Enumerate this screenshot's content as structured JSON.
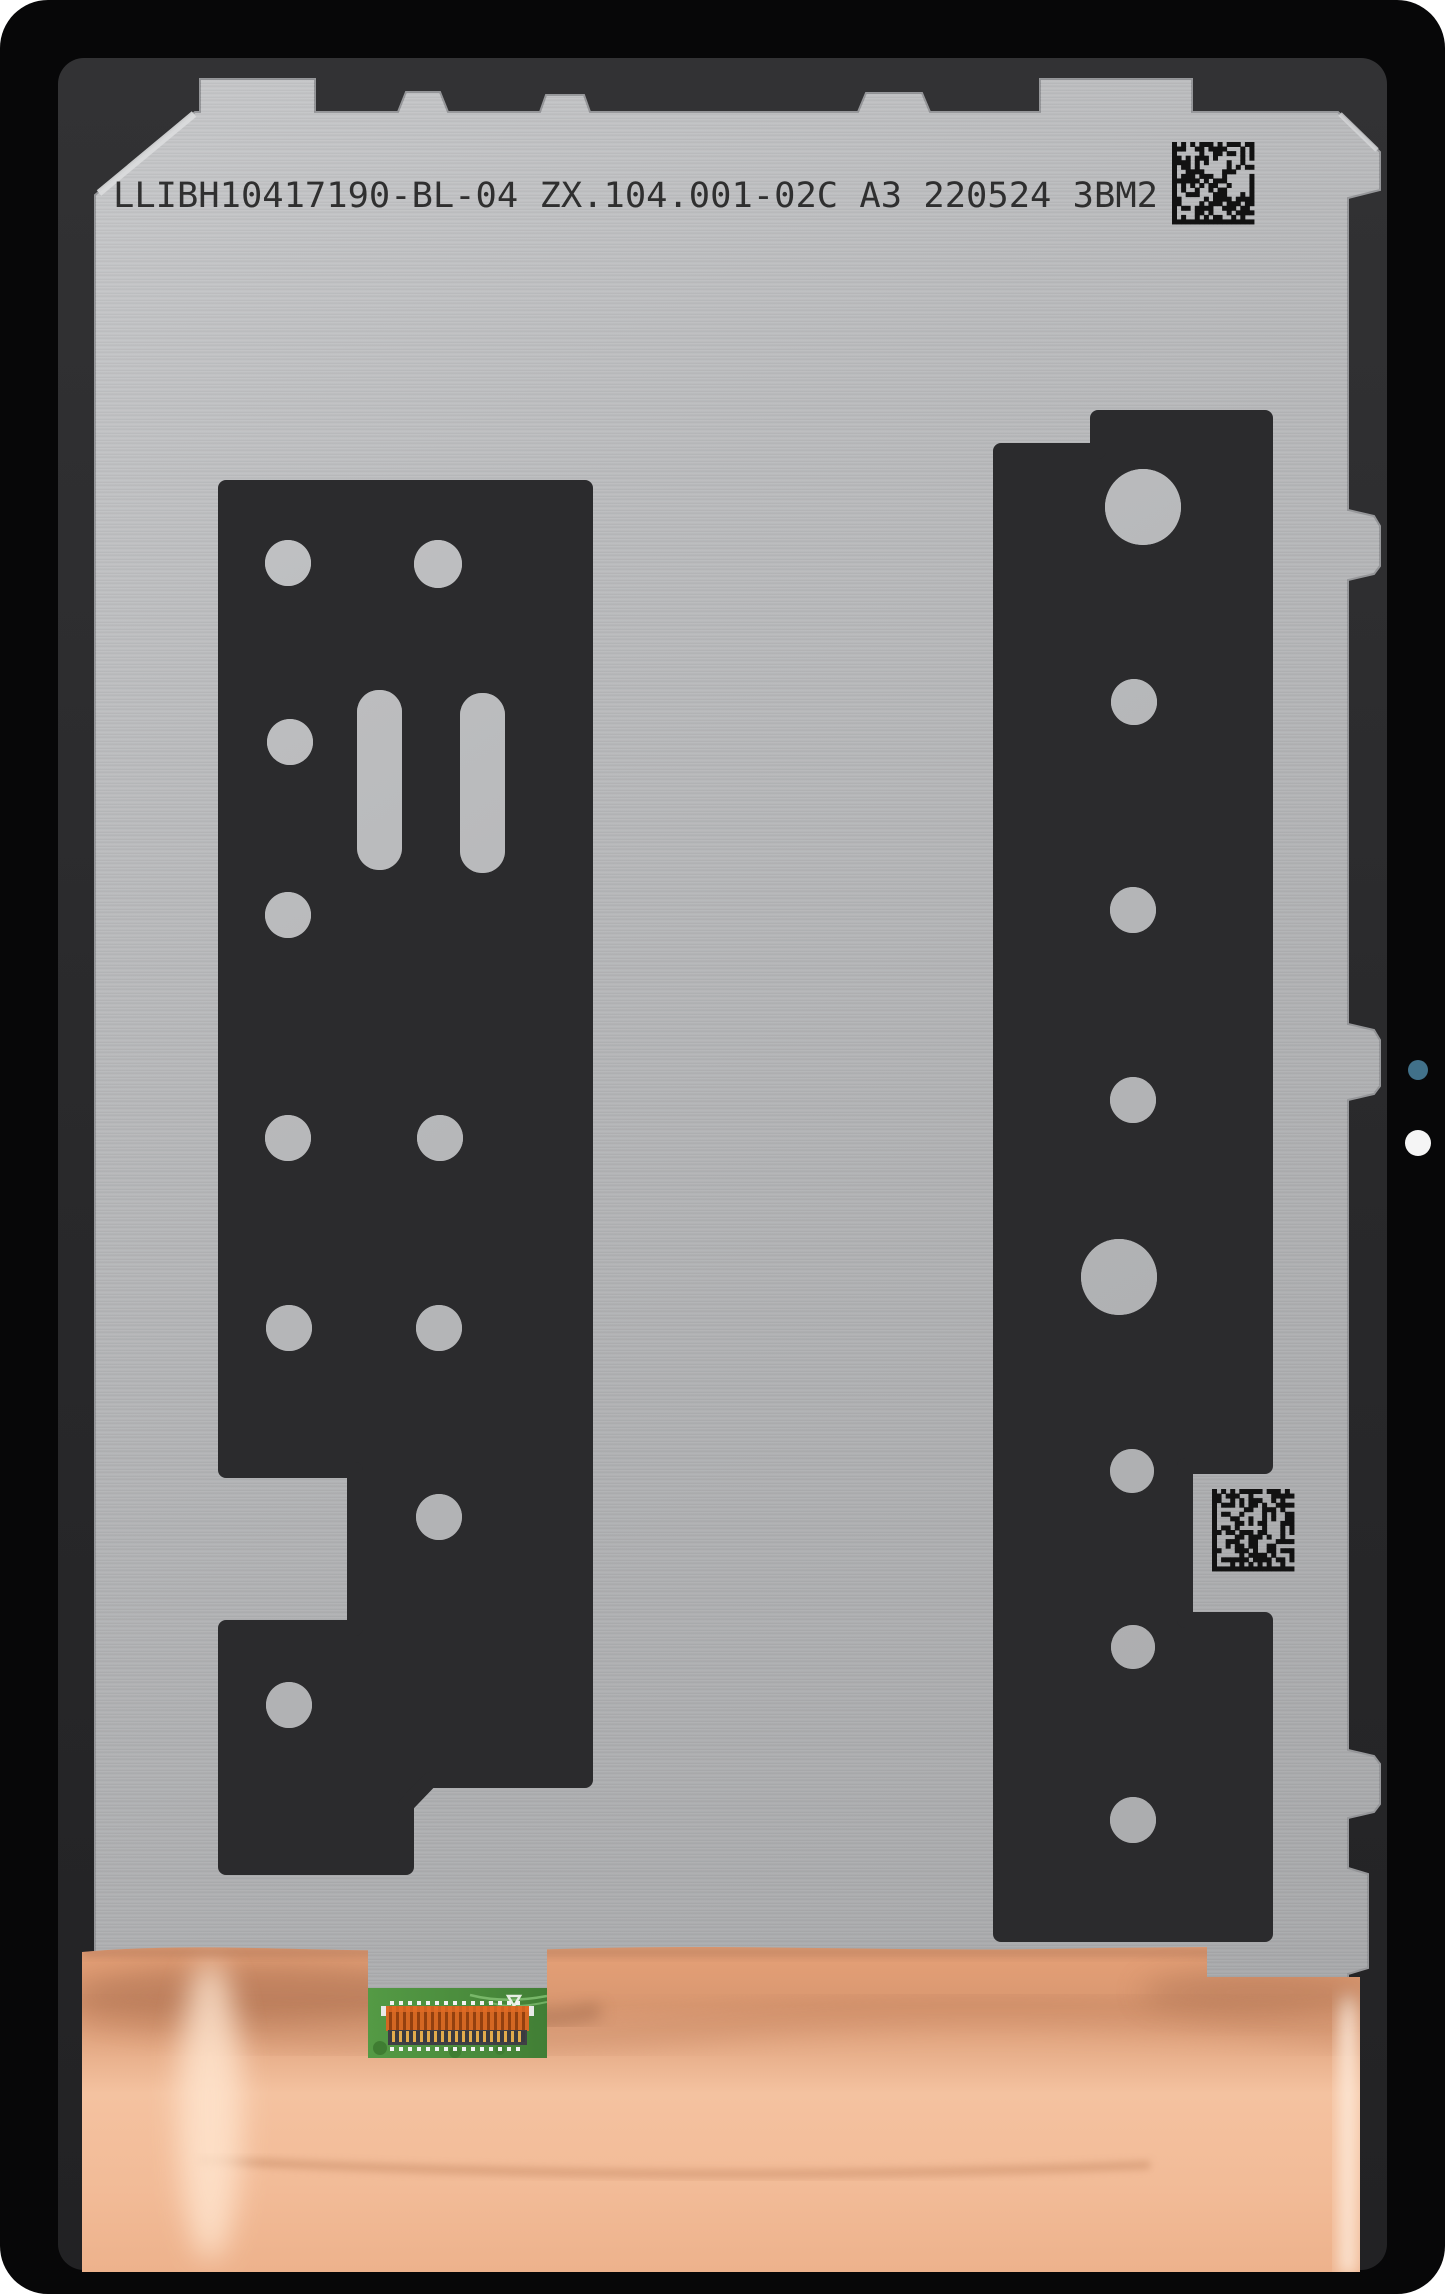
{
  "scene": {
    "description": "Rear view product photo of a tablet LCD display assembly spare part",
    "width_px": 1445,
    "height_px": 2294
  },
  "panel": {
    "marking_text": "LLIBH10417190-BL-04 ZX.104.001-02C A3 220524 3BM2",
    "marking_fields": {
      "part_number": "LLIBH10417190-BL-04",
      "model_code": "ZX.104.001-02C",
      "revision": "A3",
      "date_code": "220524",
      "lot_code": "3BM2"
    }
  },
  "pcb": {
    "component_label": "U3",
    "corner_label": "C10"
  },
  "codes": {
    "top_right": "data-matrix-2d-code",
    "middle_right": "data-matrix-2d-code",
    "modules": 18
  },
  "colors": {
    "bezel_black": "#070708",
    "inner_frame_charcoal": "#2a2a2c",
    "metal_silver": "#b5b6b8",
    "adhesive_black": "#2b2b2d",
    "copper_foil": "#f0b48e",
    "pcb_green": "#4d8f3e",
    "connector_orange": "#cc5f1e",
    "lens_dot_blue": "#41718a",
    "dot_white": "#f5f5f5",
    "marking_ink": "#1c1c1c"
  }
}
